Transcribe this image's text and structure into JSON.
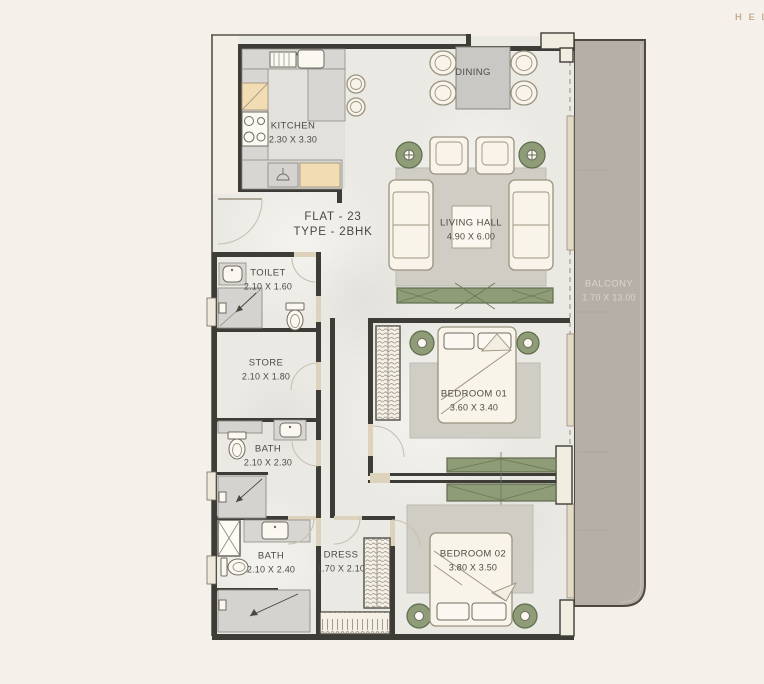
{
  "page": {
    "background": "#f5f1ea",
    "watermark": "H E L"
  },
  "plan": {
    "title": {
      "line1": "FLAT - 23",
      "line2": "TYPE - 2BHK"
    },
    "rooms": [
      {
        "id": "kitchen",
        "name": "KITCHEN",
        "dim": "2.30 X 3.30"
      },
      {
        "id": "dining",
        "name": "DINING",
        "dim": ""
      },
      {
        "id": "living-hall",
        "name": "LIVING HALL",
        "dim": "4.90 X 6.00"
      },
      {
        "id": "balcony",
        "name": "BALCONY",
        "dim": "1.70 X 13.00"
      },
      {
        "id": "toilet",
        "name": "TOILET",
        "dim": "2.10 X 1.60"
      },
      {
        "id": "store",
        "name": "STORE",
        "dim": "2.10 X 1.80"
      },
      {
        "id": "bath-1",
        "name": "BATH",
        "dim": "2.10 X 2.30"
      },
      {
        "id": "bath-2",
        "name": "BATH",
        "dim": "2.10 X 2.40"
      },
      {
        "id": "dress",
        "name": "DRESS",
        "dim": "1.70 X 2.10"
      },
      {
        "id": "bedroom-01",
        "name": "BEDROOM 01",
        "dim": "3.60 X 3.40"
      },
      {
        "id": "bedroom-02",
        "name": "BEDROOM 02",
        "dim": "3.80 X 3.50"
      }
    ],
    "colors": {
      "wall": "#3e3c37",
      "floor": "#eae9e4",
      "balcony": "#b6afa7",
      "accent_green": "#8e9c77",
      "cabinet_beige": "#f1dcb4",
      "counter_gray": "#d7d6d2",
      "furniture_cream": "#f8f4ea",
      "label_text": "#4e4b45",
      "watermark_tan": "#c9ae93"
    }
  }
}
